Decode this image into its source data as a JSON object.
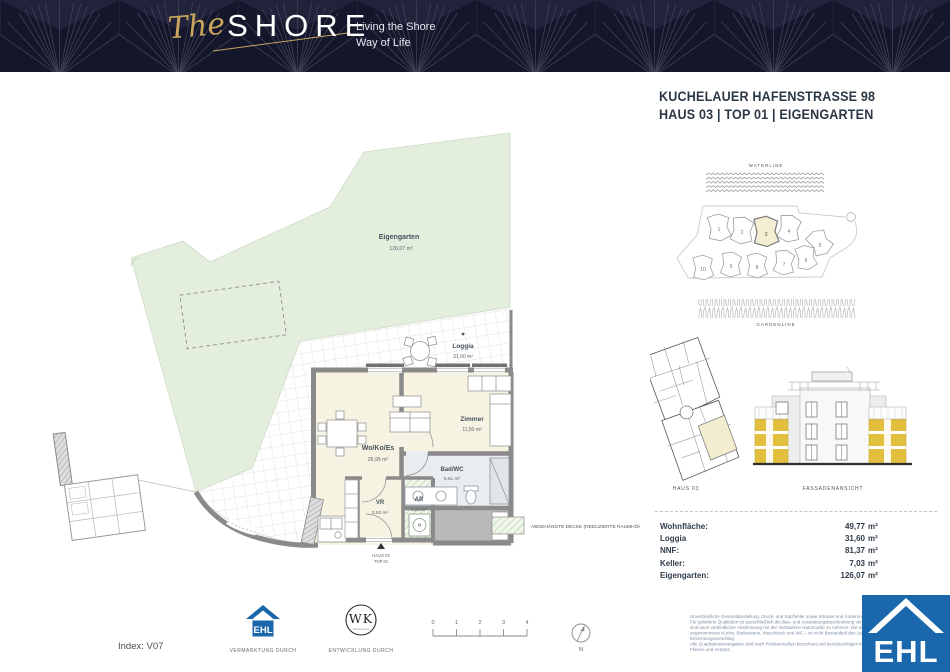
{
  "header": {
    "brand_script": "The",
    "brand_main": "SHORE",
    "tagline1": "Living the Shore",
    "tagline2": "Way of Life"
  },
  "unit_title": {
    "line1": "KUCHELAUER HAFENSTRASSE 98",
    "line2": "HAUS 03 | TOP 01 | EIGENGARTEN"
  },
  "site_plan": {
    "waterline": "WATERLINE",
    "gardenline": "GARDENLINE",
    "building_numbers": [
      "1",
      "2",
      "3",
      "4",
      "5",
      "6",
      "7",
      "8",
      "9",
      "10"
    ],
    "highlighted_building": "3"
  },
  "overview": {
    "haus_caption": "HAUS 03",
    "facade_caption": "FASSADENANSICHT"
  },
  "floor_plan": {
    "rooms": [
      {
        "name": "Eigengarten",
        "area": "126,07 m²"
      },
      {
        "name": "Loggia",
        "area": "31,60 m²"
      },
      {
        "name": "Wo/Ko/Es",
        "area": "26,95 m²"
      },
      {
        "name": "Zimmer",
        "area": "11,50 m²"
      },
      {
        "name": "Bad/WC",
        "area": "5,61 m²"
      },
      {
        "name": "VR",
        "area": "3,93 m²"
      },
      {
        "name": "AR",
        "area": "1,23 m²"
      }
    ],
    "entrance_line1": "HAUS 03",
    "entrance_line2": "TOP 01"
  },
  "legend": {
    "deck_label": "ABGEHÄNGTE DECKE (REDUZIERTE RAUMHÖHE)"
  },
  "area_table": {
    "rows": [
      {
        "label": "Wohnfläche:",
        "value": "49,77",
        "unit": "m²"
      },
      {
        "label": "Loggia",
        "value": "31,60",
        "unit": "m²"
      },
      {
        "label": "NNF:",
        "value": "81,37",
        "unit": "m²"
      },
      {
        "label": "Keller:",
        "value": "7,03",
        "unit": "m²"
      },
      {
        "label": "Eigengarten:",
        "value": "126,07",
        "unit": "m²"
      }
    ]
  },
  "footer": {
    "index_label": "Index: V07",
    "ehl_small": "EHL",
    "vermarktung_caption": "VERMARKTUNG DURCH",
    "wk_logo": "WK",
    "wk_sub": "Development",
    "entwicklung_caption": "ENTWICKLUNG DURCH",
    "scale_ticks": [
      "0",
      "1",
      "2",
      "3",
      "4"
    ],
    "north_label": "N",
    "legal_lines": [
      "Unverbindliche Gesamtdarstellung. Druck- und Satzfehler sowie Irrtümer und Änderungen vorbehalten.",
      "Für gelieferte Qualitäten ist ausschließlich die Bau- und Ausstattungsbeschreibung verbindlich. Für Einrichtungsgegenstände",
      "sind nach verbindlicher Abstimmung mit der Verkäuferin Naturmaße zu nehmen. Die dargestellte Möblierung wie beispielsweise",
      "angenommene Küche, Badewanne, Waschtisch und WC – ist nicht Bestandteil des Lieferumfangs und dient lediglich als",
      "Einrichtungsvorschlag.",
      "Alle Quadratmeterangaben sind nach Rohbaumaßen berechnet und berücksichtigen keine Wandbeläge wie beispielsweise",
      "Fliesen und Verputz.",
      "EHL"
    ]
  },
  "colors": {
    "header_navy": "#14162b",
    "gold": "#c9a55e",
    "garden_green": "#e4eedd",
    "room_cream": "#f7f3e2",
    "facade_yellow": "#e3bf3f",
    "wall_gray": "#8a8a8a",
    "ehl_blue": "#1a67ab"
  }
}
